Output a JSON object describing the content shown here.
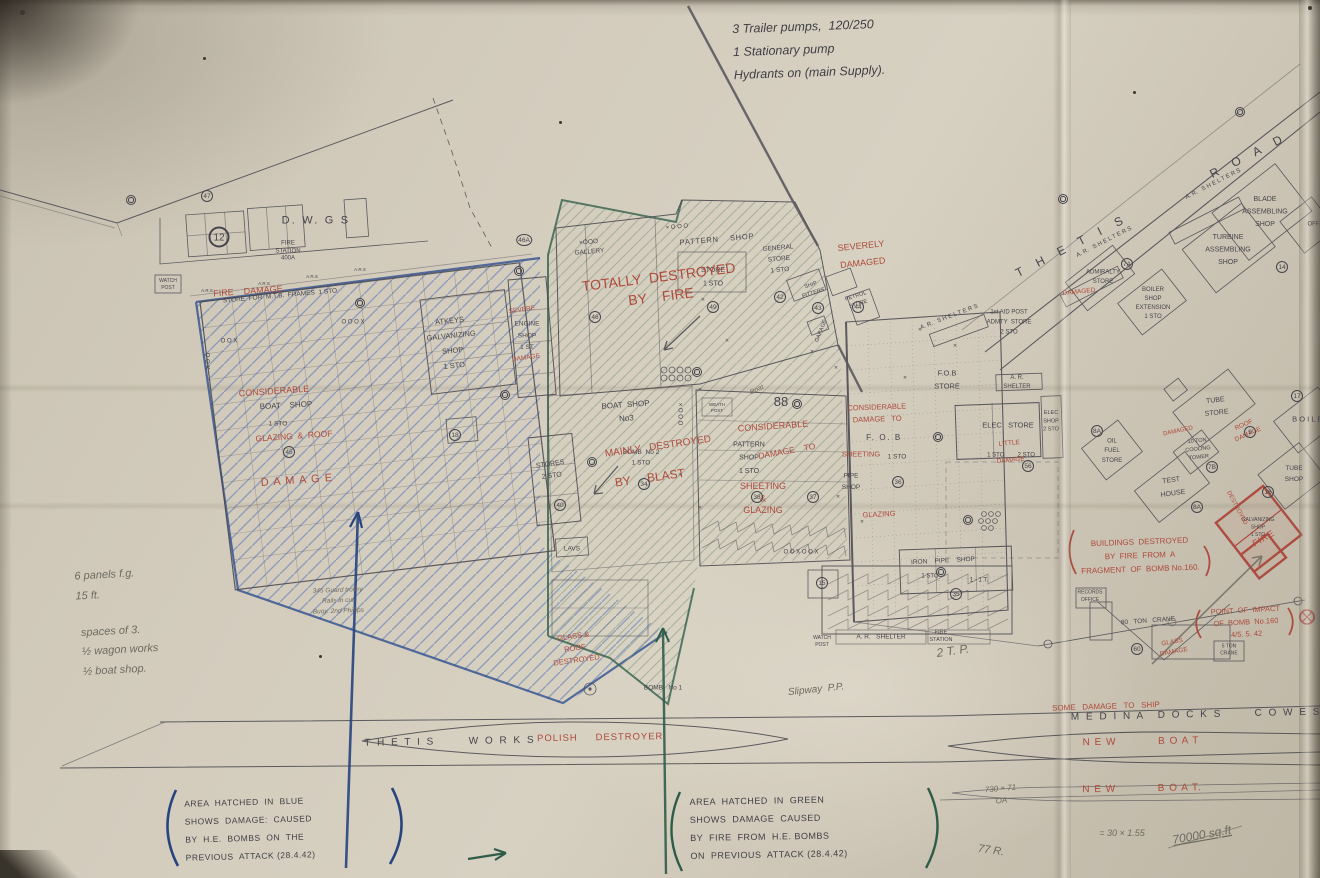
{
  "palette": {
    "paper": "#cfc8ba",
    "ink": "#45444b",
    "red": "#ad4a3a",
    "blue": "#27447e",
    "green": "#2f5c49",
    "pencil": "#6d6a60",
    "hatch_blue": "#6f87b8",
    "hatch_green": "#87987f"
  },
  "annotations": {
    "pump_note": "3 Trailer pumps,  120/250\n1 Stationary pump\nHydrants on (main Supply).",
    "panel_note": "6 panels f.g.\n15 ft.",
    "spaces_note": "spaces of 3.\n½ wagon works\n½ boat shop.",
    "legend_blue": "AREA  HATCHED  IN  BLUE\nSHOWS  DAMAGE:  CAUSED\nBY  H.E.  BOMBS  ON  THE\nPREVIOUS  ATTACK (28.4.42)",
    "legend_green": "AREA  HATCHED  IN  GREEN\nSHOWS  DAMAGE  CAUSED\nBY  FIRE  FROM  H.E. BOMBS\nON  PREVIOUS  ATTACK (28.4.42)"
  },
  "labels": [
    {
      "n": "road-thetis",
      "t": "T H E T I S          R O A D",
      "x": 1152,
      "y": 206,
      "fs": 12,
      "r": -27,
      "ls": 5
    },
    {
      "n": "dwgs",
      "t": "D. W. G S",
      "x": 316,
      "y": 221,
      "fs": 11,
      "ls": 2
    },
    {
      "n": "fire-station-400a",
      "t": "FIRE\nSTATION\n400A",
      "x": 288,
      "y": 251,
      "fs": 6,
      "lh": 1.25
    },
    {
      "n": "mtb-frames-store",
      "t": "STORE  FOR  M.T.B.  FRAMES  1 STO",
      "x": 280,
      "y": 296,
      "fs": 6.5,
      "r": -5
    },
    {
      "n": "atkeys-shop",
      "t": "ATKEYS\nGALVANIZING\nSHOP\n1 STO",
      "x": 452,
      "y": 344,
      "fs": 7.5,
      "r": -6,
      "lh": 2.0
    },
    {
      "n": "engine-shop",
      "t": "ENGINE\nSHOP\n1 ST",
      "x": 527,
      "y": 336,
      "fs": 6.5,
      "lh": 1.8
    },
    {
      "n": "pattern-shop-n",
      "t": "PATTERN    SHOP",
      "x": 717,
      "y": 240,
      "fs": 7.5,
      "r": -5,
      "ls": 1
    },
    {
      "n": "store-n",
      "t": "STORE\n1 STO",
      "x": 713,
      "y": 277,
      "fs": 7,
      "lh": 1.9
    },
    {
      "n": "general-store",
      "t": "GENERAL\nSTORE\n1 STO",
      "x": 779,
      "y": 259,
      "fs": 6.5,
      "r": -5,
      "lh": 1.7
    },
    {
      "n": "gallery",
      "t": "×OOO\nGALLERY",
      "x": 589,
      "y": 247,
      "fs": 6.5,
      "r": -5,
      "lh": 1.5
    },
    {
      "n": "xooo-n",
      "t": "× O O O",
      "x": 677,
      "y": 227,
      "fs": 6,
      "r": -5
    },
    {
      "n": "boat-shop-no3",
      "t": "BOAT  SHOP\nNo3",
      "x": 626,
      "y": 412,
      "fs": 8,
      "r": -4,
      "lh": 1.7
    },
    {
      "n": "stores-2sto",
      "t": "STORES\n2 STO",
      "x": 551,
      "y": 470,
      "fs": 7,
      "r": -8,
      "lh": 1.7
    },
    {
      "n": "bomb-no2",
      "t": "BOMB  No 2\n1 STO",
      "x": 641,
      "y": 458,
      "fs": 6.5,
      "lh": 1.6
    },
    {
      "n": "pattern-shop-c",
      "t": "PATTERN\nSHOP\n1 STO",
      "x": 749,
      "y": 458,
      "fs": 7,
      "lh": 1.9
    },
    {
      "n": "lavs",
      "t": "LAVS",
      "x": 572,
      "y": 549,
      "fs": 6.5
    },
    {
      "n": "fob-store",
      "t": "F.O.B\nSTORE",
      "x": 947,
      "y": 380,
      "fs": 7.5,
      "lh": 1.7
    },
    {
      "n": "fob",
      "t": "F. O. B",
      "x": 884,
      "y": 438,
      "fs": 8,
      "ls": 2
    },
    {
      "n": "fob-sto",
      "t": "1 STO",
      "x": 897,
      "y": 457,
      "fs": 6.5
    },
    {
      "n": "pipe-shop",
      "t": "PIPE\nSHOP",
      "x": 851,
      "y": 482,
      "fs": 6.5,
      "lh": 1.8
    },
    {
      "n": "elec-store",
      "t": "ELEC   STORE",
      "x": 1008,
      "y": 426,
      "fs": 7.5
    },
    {
      "n": "elec-store-sto",
      "t": "1 STO        2 STO",
      "x": 1011,
      "y": 455,
      "fs": 6
    },
    {
      "n": "elec-shop",
      "t": "ELEC\nSHOP\n2 STO",
      "x": 1051,
      "y": 421,
      "fs": 5.5,
      "lh": 1.5
    },
    {
      "n": "ar-shelter-ne",
      "t": "A. R.\nSHELTER",
      "x": 1017,
      "y": 382,
      "fs": 6,
      "lh": 1.5
    },
    {
      "n": "iron-pipe-shop",
      "t": "IRON    PIPE    SHOP",
      "x": 943,
      "y": 561,
      "fs": 6.5,
      "r": -3
    },
    {
      "n": "iron-pipe-sto",
      "t": "1 STO",
      "x": 930,
      "y": 576,
      "fs": 6
    },
    {
      "n": "iron-pipe-t",
      "t": "1 - 1 T.",
      "x": 979,
      "y": 580,
      "fs": 6
    },
    {
      "n": "ar-shelter-s",
      "t": "A. R.   SHELTER",
      "x": 881,
      "y": 637,
      "fs": 6.5
    },
    {
      "n": "fire-station-s",
      "t": "FIRE\nSTATION",
      "x": 941,
      "y": 636,
      "fs": 5.5,
      "lh": 1.35
    },
    {
      "n": "watch-post-s",
      "t": "WATCH\nPOST",
      "x": 822,
      "y": 641,
      "fs": 5,
      "lh": 1.35
    },
    {
      "n": "watch-post-w",
      "t": "WATCH\nPOST",
      "x": 168,
      "y": 284,
      "fs": 5,
      "lh": 1.35
    },
    {
      "n": "aid-post-admty",
      "t": "1st AID POST\nADMTY  STORE\n2 STO",
      "x": 1009,
      "y": 322,
      "fs": 6,
      "lh": 1.7
    },
    {
      "n": "petrol-store",
      "t": "PETROL\nSTORE",
      "x": 857,
      "y": 300,
      "fs": 5.5,
      "r": -18,
      "lh": 1.5
    },
    {
      "n": "ship-fitters",
      "t": "SHIP\nFITTERS",
      "x": 812,
      "y": 289,
      "fs": 5.5,
      "r": -18,
      "lh": 1.5
    },
    {
      "n": "garage",
      "t": "GARAGE",
      "x": 821,
      "y": 331,
      "fs": 5.5,
      "r": -68
    },
    {
      "n": "ar-shelters-1",
      "t": "A. R.   S H E L T E R S",
      "x": 949,
      "y": 317,
      "fs": 6,
      "r": -21
    },
    {
      "n": "ar-shelters-2",
      "t": "A. R.   S H E L T E R S",
      "x": 1104,
      "y": 242,
      "fs": 6,
      "r": -27
    },
    {
      "n": "ar-shelters-3",
      "t": "A. R.   S H E L T E R S",
      "x": 1213,
      "y": 184,
      "fs": 6,
      "r": -27
    },
    {
      "n": "blade-assembling-shop",
      "t": "BLADE\nASSEMBLING\nSHOP",
      "x": 1265,
      "y": 212,
      "fs": 7,
      "lh": 1.8
    },
    {
      "n": "turbine-assembling-shop",
      "t": "TURBINE\nASSEMBLING\nSHOP",
      "x": 1228,
      "y": 250,
      "fs": 7,
      "lh": 1.8
    },
    {
      "n": "offices",
      "t": "OFF.",
      "x": 1314,
      "y": 224,
      "fs": 6
    },
    {
      "n": "admiralty-store",
      "t": "ADMIRALTY\nSTORE",
      "x": 1103,
      "y": 277,
      "fs": 6,
      "lh": 1.6
    },
    {
      "n": "boiler-shop-extension",
      "t": "BOILER\nSHOP\nEXTENSION\n1 STO",
      "x": 1153,
      "y": 303,
      "fs": 6,
      "lh": 1.5
    },
    {
      "n": "boiler-shop",
      "t": "B O I L E R",
      "x": 1311,
      "y": 420,
      "fs": 7.5
    },
    {
      "n": "tube-store",
      "t": "TUBE\nSTORE",
      "x": 1216,
      "y": 407,
      "fs": 7,
      "r": -6,
      "lh": 1.8
    },
    {
      "n": "cooling-tower",
      "t": "10 TON\nCOOLING\nTOWER",
      "x": 1198,
      "y": 449,
      "fs": 5.5,
      "r": -6,
      "lh": 1.5
    },
    {
      "n": "oil-fuel-store",
      "t": "OIL\nFUEL\nSTORE",
      "x": 1112,
      "y": 451,
      "fs": 6,
      "lh": 1.6
    },
    {
      "n": "test-house",
      "t": "TEST\nHOUSE",
      "x": 1172,
      "y": 487,
      "fs": 7,
      "r": -8,
      "lh": 1.9
    },
    {
      "n": "tube-shop",
      "t": "TUBE\nSHOP",
      "x": 1294,
      "y": 474,
      "fs": 6.5,
      "lh": 1.7
    },
    {
      "n": "galvanizing-shop-destroyed",
      "t": "GALVANIZING\nSHOP\n1 STO",
      "x": 1258,
      "y": 527,
      "fs": 5,
      "lh": 1.5
    },
    {
      "n": "records-office",
      "t": "RECORDS\nOFFICE",
      "x": 1090,
      "y": 596,
      "fs": 5,
      "lh": 1.5
    },
    {
      "n": "crane-80-ton",
      "t": "80   TON   CRANE",
      "x": 1148,
      "y": 621,
      "fs": 6.5,
      "r": -4
    },
    {
      "n": "crane-5-ton",
      "t": "5 TON\nCRANE",
      "x": 1229,
      "y": 650,
      "fs": 5,
      "lh": 1.4
    },
    {
      "n": "medina",
      "t": "M E D I N A",
      "x": 1108,
      "y": 717,
      "fs": 10,
      "ls": 2,
      "r": -1
    },
    {
      "n": "docks",
      "t": "D O C K S",
      "x": 1190,
      "y": 715,
      "fs": 10,
      "ls": 2,
      "r": -1
    },
    {
      "n": "cowes",
      "t": "C O W E S",
      "x": 1288,
      "y": 713,
      "fs": 10,
      "ls": 2,
      "r": -1
    },
    {
      "n": "thetis-works",
      "t": "T H E T I S       W O R K S",
      "x": 450,
      "y": 742,
      "fs": 10,
      "ls": 2,
      "r": -1
    },
    {
      "n": "polish-destroyer",
      "c": "red",
      "t": "POLISH     DESTROYER.",
      "x": 602,
      "y": 738,
      "fs": 9.5,
      "ls": 1,
      "r": -1
    },
    {
      "n": "new-boat-1",
      "c": "red",
      "t": "N E W           B O A T",
      "x": 1141,
      "y": 742,
      "fs": 10,
      "ls": 1,
      "r": -1
    },
    {
      "n": "new-boat-2",
      "c": "red",
      "t": "N E W           B O A T.",
      "x": 1142,
      "y": 789,
      "fs": 10,
      "ls": 1,
      "r": -1
    },
    {
      "n": "some-damage-to-ship",
      "c": "red",
      "t": "SOME   DAMAGE   TO   SHIP",
      "x": 1106,
      "y": 707,
      "fs": 8,
      "r": -2
    },
    {
      "n": "severely-damaged",
      "c": "red",
      "t": "SEVERELY\nDAMAGED",
      "x": 862,
      "y": 255,
      "fs": 9,
      "r": -6,
      "lh": 1.9
    },
    {
      "n": "totally-destroyed-by-fire",
      "c": "red",
      "t": "TOTALLY  DESTROYED\nBY    FIRE",
      "x": 660,
      "y": 288,
      "fs": 14,
      "r": -7,
      "lh": 1.35
    },
    {
      "n": "fire-damage-nw",
      "c": "red",
      "t": "FIRE    DAMAGE",
      "x": 248,
      "y": 292,
      "fs": 9,
      "r": -4
    },
    {
      "n": "considerable-w",
      "c": "red",
      "t": "CONSIDERABLE",
      "x": 274,
      "y": 392,
      "fs": 9,
      "r": -4
    },
    {
      "n": "boat-shop-w",
      "t": "BOAT    SHOP",
      "x": 286,
      "y": 406,
      "fs": 8,
      "r": -3
    },
    {
      "n": "boat-shop-w-sto",
      "t": "1 STO",
      "x": 278,
      "y": 424,
      "fs": 6.5
    },
    {
      "n": "glazing-roof-w",
      "c": "red",
      "t": "GLAZING  &  ROOF",
      "x": 294,
      "y": 437,
      "fs": 8.5,
      "r": -4
    },
    {
      "n": "damage-w",
      "c": "red",
      "t": "D A M A G E",
      "x": 297,
      "y": 481,
      "fs": 11,
      "r": -4,
      "ls": 1
    },
    {
      "n": "severe-engine",
      "c": "red",
      "t": "SEVERE",
      "x": 522,
      "y": 310,
      "fs": 6.5,
      "r": -8
    },
    {
      "n": "damage-engine",
      "c": "red",
      "t": "DAMAGE",
      "x": 526,
      "y": 358,
      "fs": 6.5,
      "r": -8
    },
    {
      "n": "mainly-destroyed",
      "c": "red",
      "t": "MAINLY   DESTROYED",
      "x": 658,
      "y": 447,
      "fs": 10,
      "r": -8
    },
    {
      "n": "by-blast",
      "c": "red",
      "t": "BY     BLAST",
      "x": 650,
      "y": 479,
      "fs": 12,
      "r": -8
    },
    {
      "n": "considerable-e",
      "c": "red",
      "t": "CONSIDERABLE",
      "x": 773,
      "y": 427,
      "fs": 9,
      "r": -4
    },
    {
      "n": "damage-to-e",
      "c": "red",
      "t": "DAMAGE    TO",
      "x": 787,
      "y": 452,
      "fs": 8.5,
      "r": -10
    },
    {
      "n": "sheeting-glazing-e",
      "c": "red",
      "t": "SHEETING\n&\nGLAZING",
      "x": 763,
      "y": 499,
      "fs": 9,
      "lh": 1.35
    },
    {
      "n": "considerable-fob",
      "c": "red",
      "t": "CONSIDERABLE\nDAMAGE   TO",
      "x": 877,
      "y": 414,
      "fs": 7.5,
      "r": -2,
      "lh": 1.6
    },
    {
      "n": "sheeting-fob",
      "c": "red",
      "t": "SHEETING",
      "x": 861,
      "y": 455,
      "fs": 7.5
    },
    {
      "n": "glazing-fob",
      "c": "red",
      "t": "GLAZING",
      "x": 879,
      "y": 515,
      "fs": 7.5,
      "r": -3
    },
    {
      "n": "little-damage-elec",
      "c": "red",
      "t": "LITTLE\nDAMAGE",
      "x": 1010,
      "y": 452,
      "fs": 6.5,
      "r": -5,
      "lh": 2.6
    },
    {
      "n": "damaged-admiralty",
      "c": "red",
      "t": "DAMAGED",
      "x": 1079,
      "y": 292,
      "fs": 6.5,
      "r": -6
    },
    {
      "n": "roof-damage-tube",
      "c": "red",
      "t": "ROOF\nDAMAGE",
      "x": 1246,
      "y": 430,
      "fs": 6.5,
      "r": -24,
      "lh": 1.6
    },
    {
      "n": "damaged-cooling",
      "c": "red",
      "t": "DAMAGED",
      "x": 1178,
      "y": 431,
      "fs": 6,
      "r": -12
    },
    {
      "n": "destroyed-galv",
      "c": "red",
      "t": "DESTROYED",
      "x": 1237,
      "y": 508,
      "fs": 6,
      "r": 62
    },
    {
      "n": "fire-galv",
      "c": "red",
      "t": "FIRE",
      "x": 1264,
      "y": 539,
      "fs": 9,
      "r": -30,
      "ls": 1
    },
    {
      "n": "buildings-destroyed-note",
      "c": "red",
      "t": "BUILDINGS  DESTROYED\nBY  FIRE  FROM  A\nFRAGMENT  OF  BOMB No.160.",
      "x": 1140,
      "y": 556,
      "fs": 8,
      "r": -2,
      "lh": 1.7
    },
    {
      "n": "point-of-impact-note",
      "c": "red",
      "t": "POINT  OF  IMPACT\nOF  BOMB  No.160\n4/5. 5. 42",
      "x": 1246,
      "y": 623,
      "fs": 7.5,
      "r": -3,
      "lh": 1.6
    },
    {
      "n": "glass-damage-crane",
      "c": "red",
      "t": "GLASS\nDAMAGE",
      "x": 1173,
      "y": 647,
      "fs": 6.5,
      "r": -10,
      "lh": 1.5
    },
    {
      "n": "glass-roof-destroyed",
      "c": "red",
      "t": "GLASS &\nROOF\nDESTROYED",
      "x": 575,
      "y": 649,
      "fs": 7.5,
      "r": -8,
      "lh": 1.6
    },
    {
      "n": "bomb-no1",
      "t": "BOMB   No 1",
      "x": 663,
      "y": 688,
      "fs": 6.5
    },
    {
      "n": "pencil-2tp",
      "c": "pencil",
      "i": 1,
      "t": "2 T. P.",
      "x": 953,
      "y": 652,
      "fs": 12,
      "r": -8
    },
    {
      "n": "pencil-slipway",
      "c": "pencil",
      "i": 1,
      "t": "Slipway  P.P.",
      "x": 816,
      "y": 690,
      "fs": 10,
      "r": -6
    },
    {
      "n": "pencil-730x71",
      "c": "pencil",
      "i": 1,
      "t": "730 × 71\nOA",
      "x": 1001,
      "y": 795,
      "fs": 8,
      "r": -5,
      "lh": 1.5
    },
    {
      "n": "pencil-30x155",
      "c": "pencil",
      "i": 1,
      "t": "= 30 × 1.55",
      "x": 1122,
      "y": 834,
      "fs": 9
    },
    {
      "n": "pencil-70000",
      "c": "pencil",
      "i": 1,
      "u": 1,
      "t": "70000 sq.ft",
      "x": 1202,
      "y": 836,
      "fs": 12,
      "r": -10
    },
    {
      "n": "pencil-77r",
      "c": "pencil",
      "i": 1,
      "t": "77 R.",
      "x": 991,
      "y": 851,
      "fs": 11,
      "r": 8
    },
    {
      "n": "pencil-trolley",
      "c": "pencil",
      "i": 1,
      "t": "345 Guard trolley\nRails in cut\nBuoy. 2nd Phillips",
      "x": 338,
      "y": 601,
      "fs": 6.5,
      "r": -2,
      "lh": 1.6
    },
    {
      "n": "pencil-boat",
      "c": "pencil",
      "i": 1,
      "t": "Boat",
      "x": 757,
      "y": 390,
      "fs": 7,
      "r": -25
    },
    {
      "n": "marks-ooox",
      "t": "O O O X",
      "x": 353,
      "y": 322,
      "fs": 6
    },
    {
      "n": "marks-oox-1",
      "t": "O O X",
      "x": 229,
      "y": 341,
      "fs": 6
    },
    {
      "n": "marks-oox-2",
      "t": "O O X",
      "x": 207,
      "y": 361,
      "fs": 6,
      "r": 90
    },
    {
      "n": "marks-xooo-v",
      "t": "× O O O",
      "x": 680,
      "y": 414,
      "fs": 6,
      "r": 90
    },
    {
      "n": "marks-88",
      "t": "88",
      "x": 781,
      "y": 403,
      "fs": 13
    },
    {
      "n": "marks-ooxoox",
      "t": "O O X O O X",
      "x": 801,
      "y": 552,
      "fs": 6
    },
    {
      "n": "weath-post",
      "t": "WEATH\nPOST",
      "x": 717,
      "y": 408,
      "fs": 4.5,
      "lh": 1.4
    },
    {
      "n": "ars-1",
      "t": "A.R.S",
      "x": 207,
      "y": 291,
      "fs": 4.5
    },
    {
      "n": "ars-2",
      "t": "A.R.S",
      "x": 264,
      "y": 284,
      "fs": 4.5
    },
    {
      "n": "ars-3",
      "t": "A.R.S",
      "x": 312,
      "y": 277,
      "fs": 4.5
    },
    {
      "n": "ars-4",
      "t": "A.R.S",
      "x": 360,
      "y": 270,
      "fs": 4.5
    }
  ],
  "circled_numbers": [
    [
      "47",
      207,
      196
    ],
    [
      "12",
      219,
      237,
      1
    ],
    [
      "46A",
      524,
      240
    ],
    [
      "46",
      595,
      317
    ],
    [
      "49",
      713,
      307
    ],
    [
      "42",
      780,
      297
    ],
    [
      "43",
      818,
      308
    ],
    [
      "44",
      858,
      307
    ],
    [
      "45",
      289,
      452
    ],
    [
      "18",
      455,
      435
    ],
    [
      "40",
      560,
      505
    ],
    [
      "34",
      644,
      484
    ],
    [
      "38",
      757,
      497
    ],
    [
      "37",
      813,
      497
    ],
    [
      "36",
      898,
      482
    ],
    [
      "35",
      956,
      594
    ],
    [
      "15",
      822,
      583
    ],
    [
      "56",
      1028,
      466
    ],
    [
      "8A",
      1097,
      431
    ],
    [
      "7B",
      1212,
      467
    ],
    [
      "9",
      1250,
      432
    ],
    [
      "16",
      1268,
      492
    ],
    [
      "8A",
      1197,
      507
    ],
    [
      "14",
      1282,
      267
    ],
    [
      "7A",
      1127,
      264
    ],
    [
      "17",
      1297,
      396
    ],
    [
      "60",
      1137,
      649
    ]
  ],
  "posts": [
    [
      131,
      200
    ],
    [
      360,
      303
    ],
    [
      505,
      395
    ],
    [
      592,
      462
    ],
    [
      697,
      372
    ],
    [
      797,
      404
    ],
    [
      938,
      437
    ],
    [
      968,
      520
    ],
    [
      941,
      572
    ],
    [
      1063,
      199
    ],
    [
      1240,
      112
    ],
    [
      519,
      271
    ]
  ],
  "x_marks": [
    [
      703,
      300
    ],
    [
      727,
      341
    ],
    [
      812,
      352
    ],
    [
      680,
      475
    ],
    [
      700,
      508
    ],
    [
      838,
      497
    ],
    [
      905,
      378
    ],
    [
      955,
      346
    ],
    [
      862,
      522
    ],
    [
      700,
      390
    ],
    [
      920,
      330
    ],
    [
      836,
      368
    ]
  ]
}
